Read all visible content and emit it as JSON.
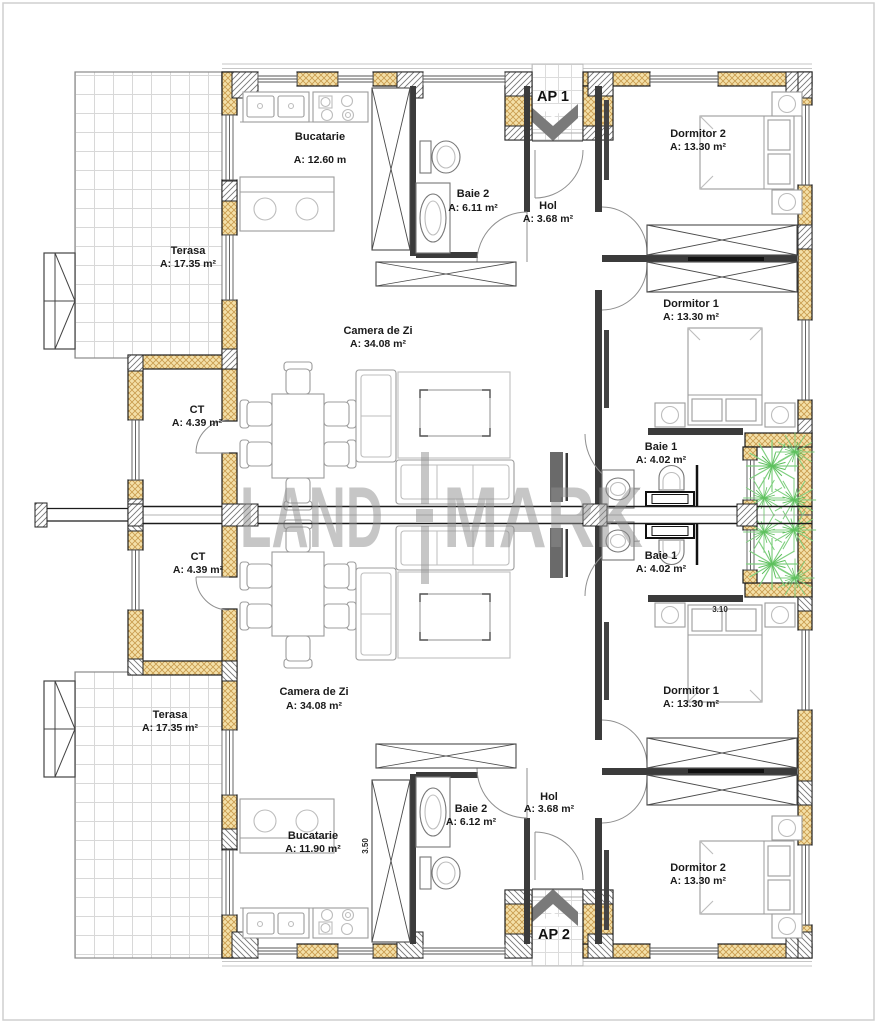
{
  "watermark": {
    "left": "LAND",
    "right": "MARK"
  },
  "entrances": [
    {
      "label": "AP 1"
    },
    {
      "label": "AP 2"
    }
  ],
  "rooms": [
    {
      "name": "Bucatarie",
      "area": "A: 12.60 m"
    },
    {
      "name": "Baie 2",
      "area": "A: 6.11 m²"
    },
    {
      "name": "Hol",
      "area": "A: 3.68 m²"
    },
    {
      "name": "Dormitor 2",
      "area": "A: 13.30 m²"
    },
    {
      "name": "Terasa",
      "area": "A: 17.35 m²"
    },
    {
      "name": "Dormitor 1",
      "area": "A: 13.30 m²"
    },
    {
      "name": "Camera de Zi",
      "area": "A: 34.08 m²"
    },
    {
      "name": "CT",
      "area": "A: 4.39 m²"
    },
    {
      "name": "Baie 1",
      "area": "A: 4.02 m²"
    },
    {
      "name": "Baie 1",
      "area": "A: 4.02 m²"
    },
    {
      "name": "CT",
      "area": "A: 4.39 m²"
    },
    {
      "name": "Camera de Zi",
      "area": "A: 34.08 m²"
    },
    {
      "name": "Dormitor 1",
      "area": "A: 13.30 m²"
    },
    {
      "name": "Terasa",
      "area": "A: 17.35 m²"
    },
    {
      "name": "Bucatarie",
      "area": "A: 11.90 m²"
    },
    {
      "name": "Baie 2",
      "area": "A: 6.12 m²"
    },
    {
      "name": "Hol",
      "area": "A: 3.68 m²"
    },
    {
      "name": "Dormitor 2",
      "area": "A: 13.30 m²"
    }
  ],
  "dimensions": [
    {
      "value": "3.10"
    },
    {
      "value": "3.50"
    }
  ],
  "colors": {
    "wall_fill": "#f4e0a8",
    "wall_hatch": "#c89b4e",
    "line": "#1c1c1c",
    "furniture": "#9c9c9c",
    "terrace_line": "#d8d8d8",
    "plant_green": "#7fcf7f",
    "watermark_gray": "#8e8e8e"
  }
}
